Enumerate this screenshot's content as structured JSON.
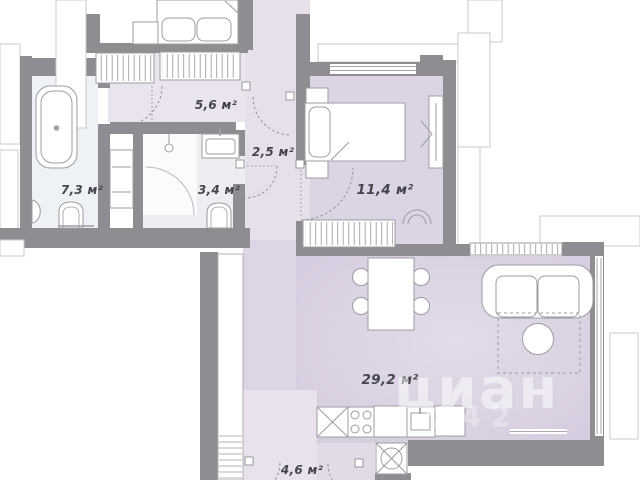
{
  "rooms": [
    {
      "id": "hallway",
      "label": "5,6 м²"
    },
    {
      "id": "inner-corridor",
      "label": "2,5 м²"
    },
    {
      "id": "bathroom-small",
      "label": "3,4 м²"
    },
    {
      "id": "bathroom-large",
      "label": "7,3 м²"
    },
    {
      "id": "bedroom",
      "label": "11,4 м²"
    },
    {
      "id": "living-kitchen",
      "label": "29,2 м²"
    },
    {
      "id": "entry-hall",
      "label": "4,6 м²"
    }
  ],
  "watermark": {
    "brand": "циан",
    "digits": "242"
  },
  "furniture_icons": [
    "bed-icon",
    "wardrobe-icon",
    "bathtub-icon",
    "toilet-icon",
    "sink-icon",
    "shower-door-icon",
    "pendant-lamp-icon",
    "sofa-icon",
    "coffee-table-icon",
    "dining-table-icon",
    "chair-icon",
    "stove-icon",
    "kitchen-sink-icon",
    "washing-machine-icon",
    "shelf-unit-icon",
    "door-swing-icon",
    "cian-pin-icon"
  ],
  "colors": {
    "wall": "#8e8e92",
    "exterior_outline": "#c9c9cd",
    "furniture_stroke": "#9c9ca2",
    "hallway_fill": "#e9e4ee",
    "corridor_fill": "#e7e0eb",
    "bedroom_fill": "#dcd3e4",
    "living_fill": "#d7cde0",
    "entry_fill": "#e9e1ec",
    "bathroom_large_fill": "#eef1f6",
    "bathroom_small_fill": "#ededf2",
    "label_text": "#45454e",
    "watermark": "#ffffff"
  }
}
